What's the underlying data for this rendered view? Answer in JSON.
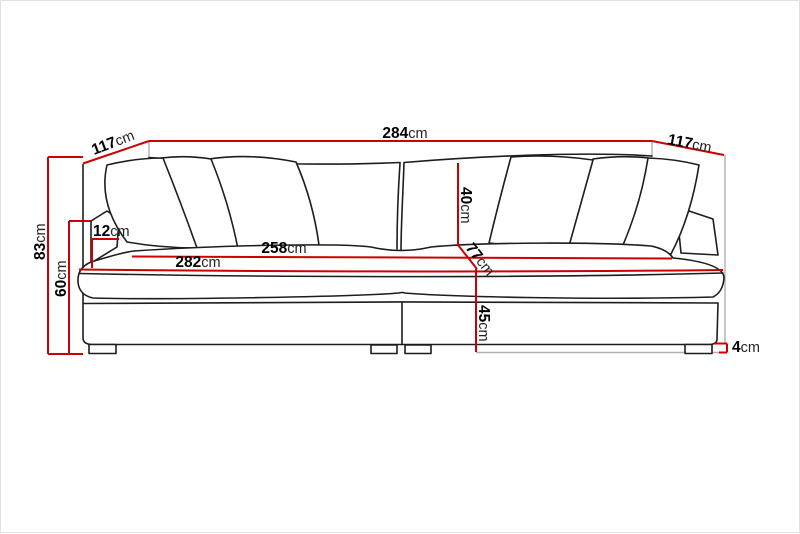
{
  "diagram": {
    "type": "furniture-dimension-drawing",
    "subject": "three-seater sofa front elevation with six back pillows, two seat sections and four legs",
    "unit": "cm",
    "colors": {
      "dimension_line": "#cc0000",
      "artwork_line": "#1d1d1d",
      "extension_line": "#b0b0b0",
      "background": "#ffffff"
    },
    "dimensions": {
      "overall_width": {
        "value": "284",
        "unit": "cm"
      },
      "depth_left": {
        "value": "117",
        "unit": "cm"
      },
      "depth_right": {
        "value": "117",
        "unit": "cm"
      },
      "total_height": {
        "value": "83",
        "unit": "cm"
      },
      "arm_height": {
        "value": "60",
        "unit": "cm"
      },
      "armrest_width": {
        "value": "12",
        "unit": "cm"
      },
      "inner_seat_width": {
        "value": "258",
        "unit": "cm"
      },
      "seat_width": {
        "value": "282",
        "unit": "cm"
      },
      "back_cushion_height": {
        "value": "40",
        "unit": "cm"
      },
      "seat_depth": {
        "value": "77",
        "unit": "cm"
      },
      "seat_height": {
        "value": "45",
        "unit": "cm"
      },
      "leg_height": {
        "value": "4",
        "unit": "cm"
      }
    }
  }
}
